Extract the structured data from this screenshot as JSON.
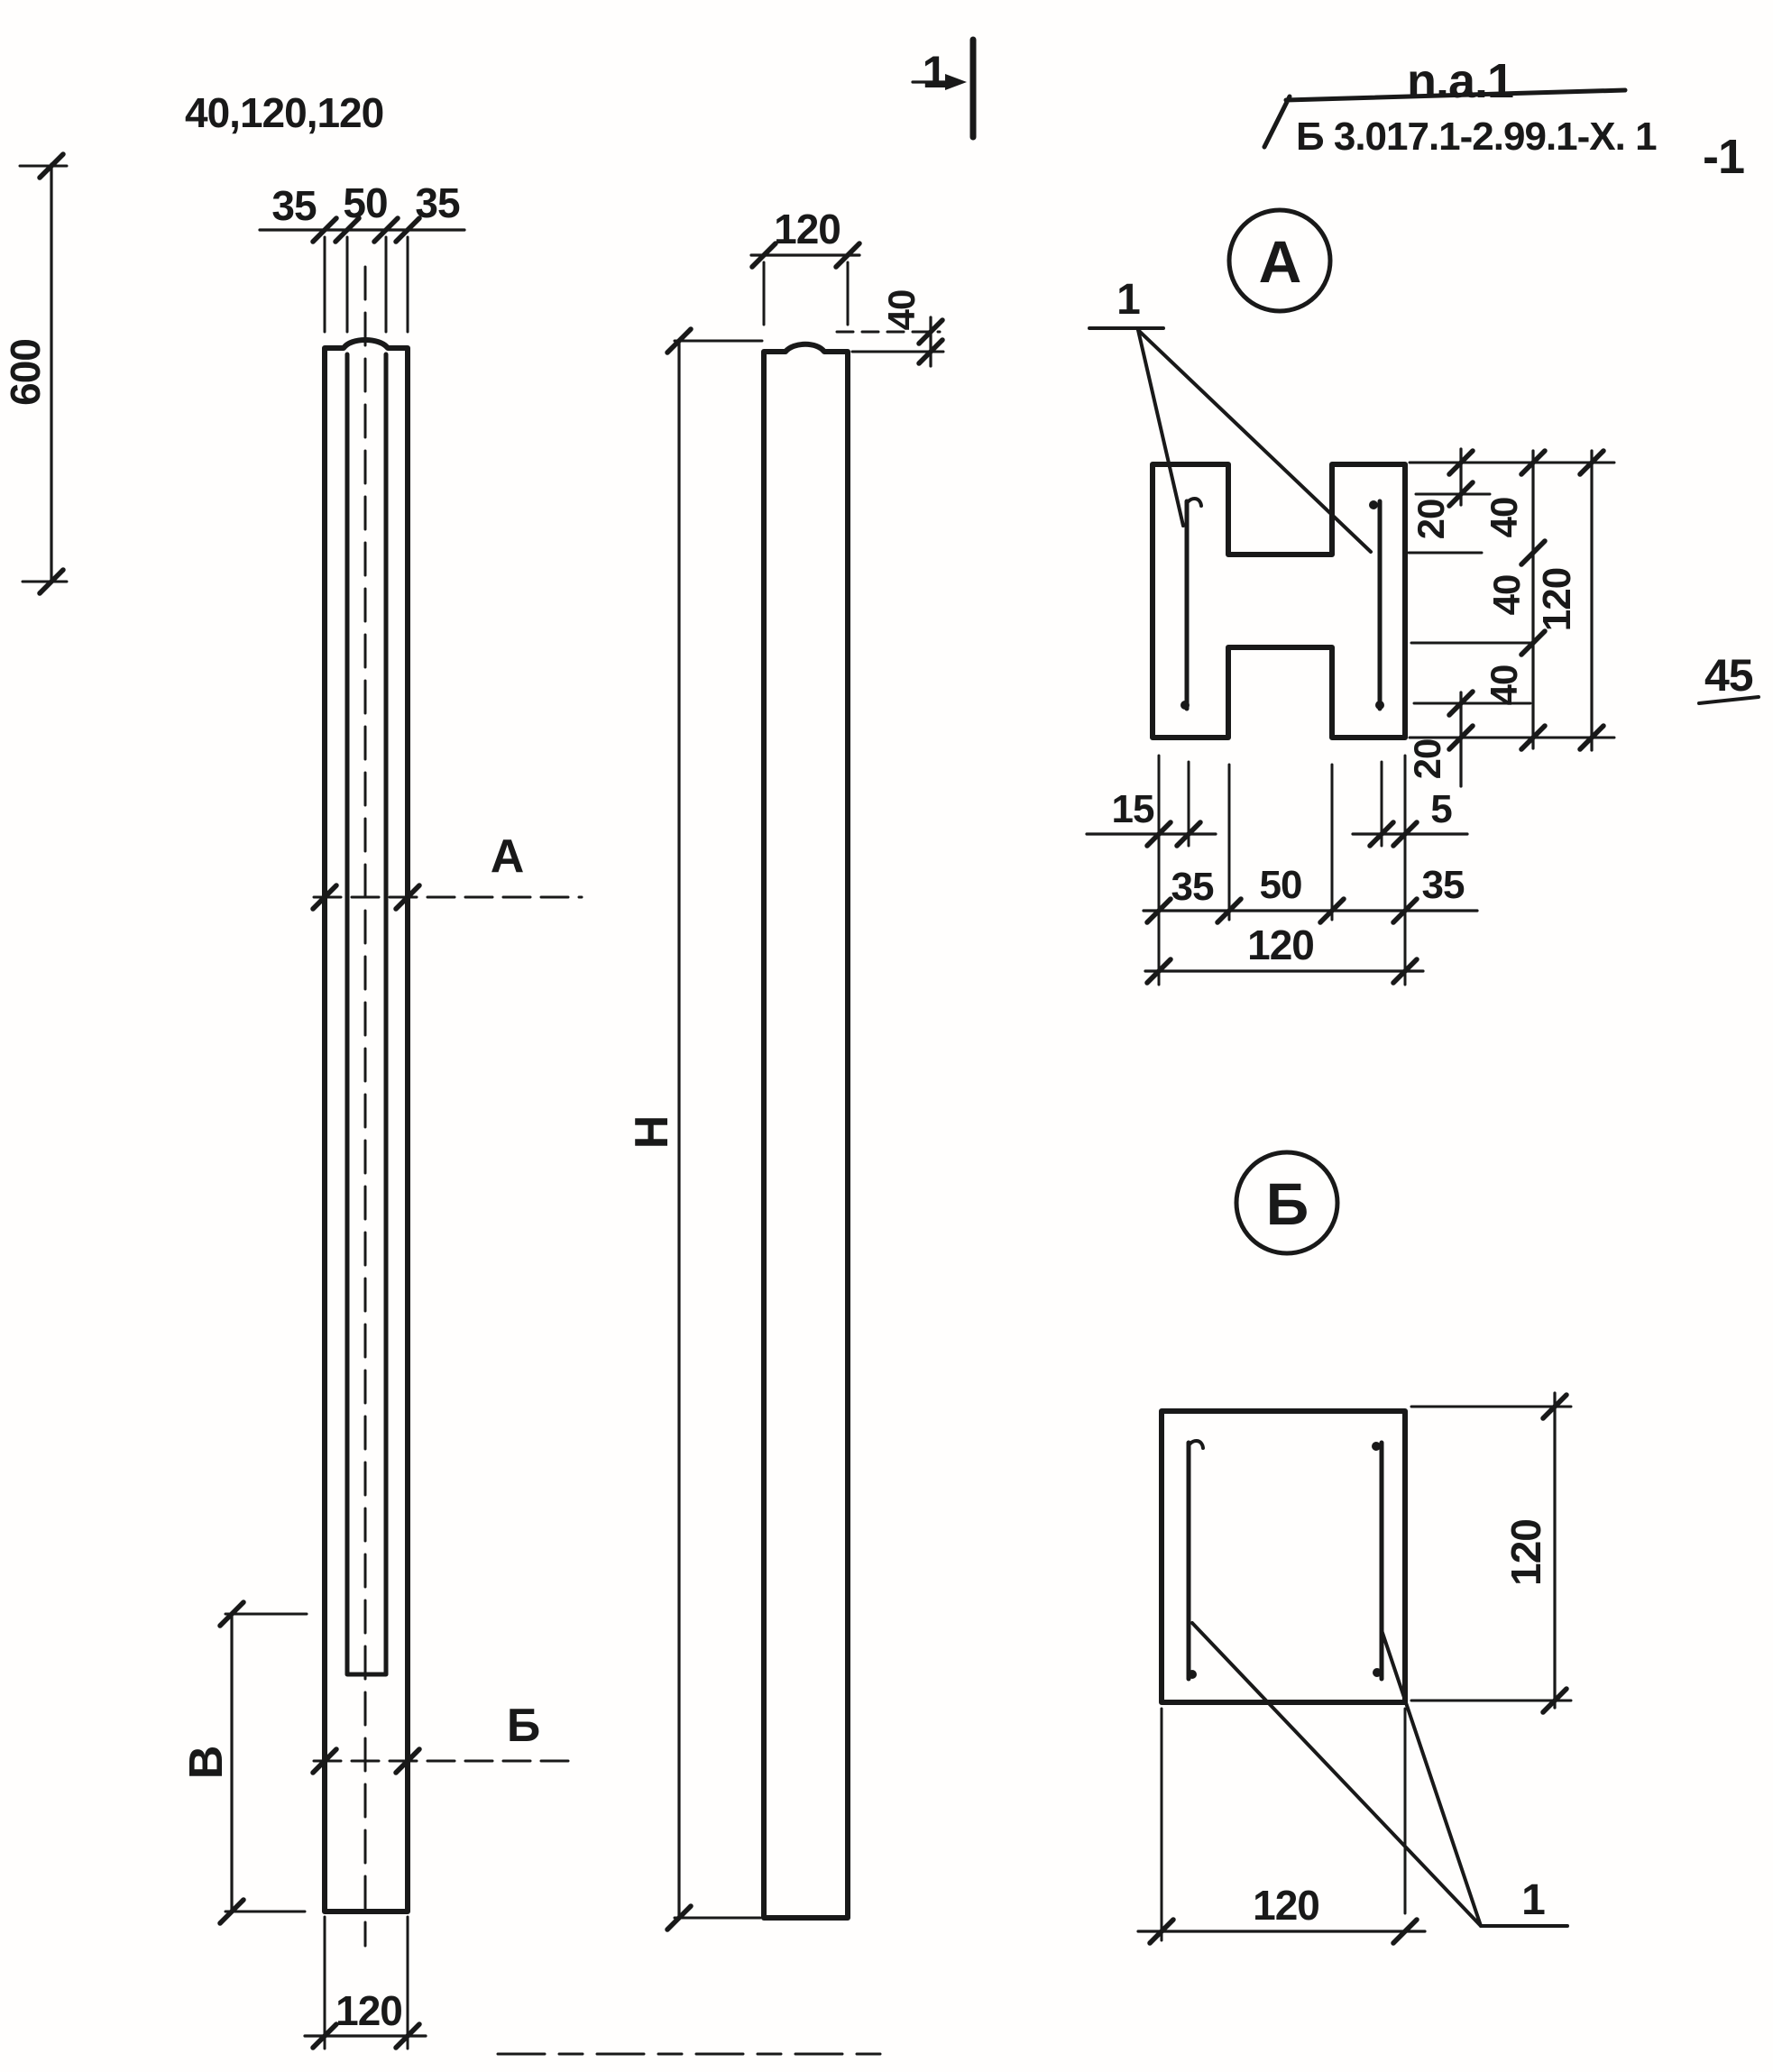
{
  "title": {
    "code_top": "n.a.1",
    "code_bottom": "Б 3.017.1-2.99.1-Х. 1",
    "rev_mark": "-1",
    "sheet_number": "45"
  },
  "cut_marker": {
    "label": "1"
  },
  "front_view": {
    "chain_dims": "40,120,120",
    "dim_35_left": "35",
    "dim_50": "50",
    "dim_35_right": "35",
    "dim_600": "600",
    "section_a_mark": "А",
    "section_b_mark": "Б",
    "dim_height_b": "В",
    "dim_120_bottom": "120"
  },
  "side_view": {
    "dim_120_top": "120",
    "dim_40_tip": "40",
    "dim_height_h": "Н"
  },
  "section_a": {
    "label": "А",
    "rebar_mark": "1",
    "dim_20_top": "20",
    "dim_40_a": "40",
    "dim_40_b": "40",
    "dim_40_c": "40",
    "dim_120_right": "120",
    "dim_20_bottom": "20",
    "dim_15": "15",
    "dim_5": "5",
    "dim_35_left": "35",
    "dim_50": "50",
    "dim_35_right": "35",
    "dim_120_bottom": "120"
  },
  "section_b": {
    "label": "Б",
    "rebar_mark": "1",
    "dim_120_right": "120",
    "dim_120_bottom": "120"
  }
}
